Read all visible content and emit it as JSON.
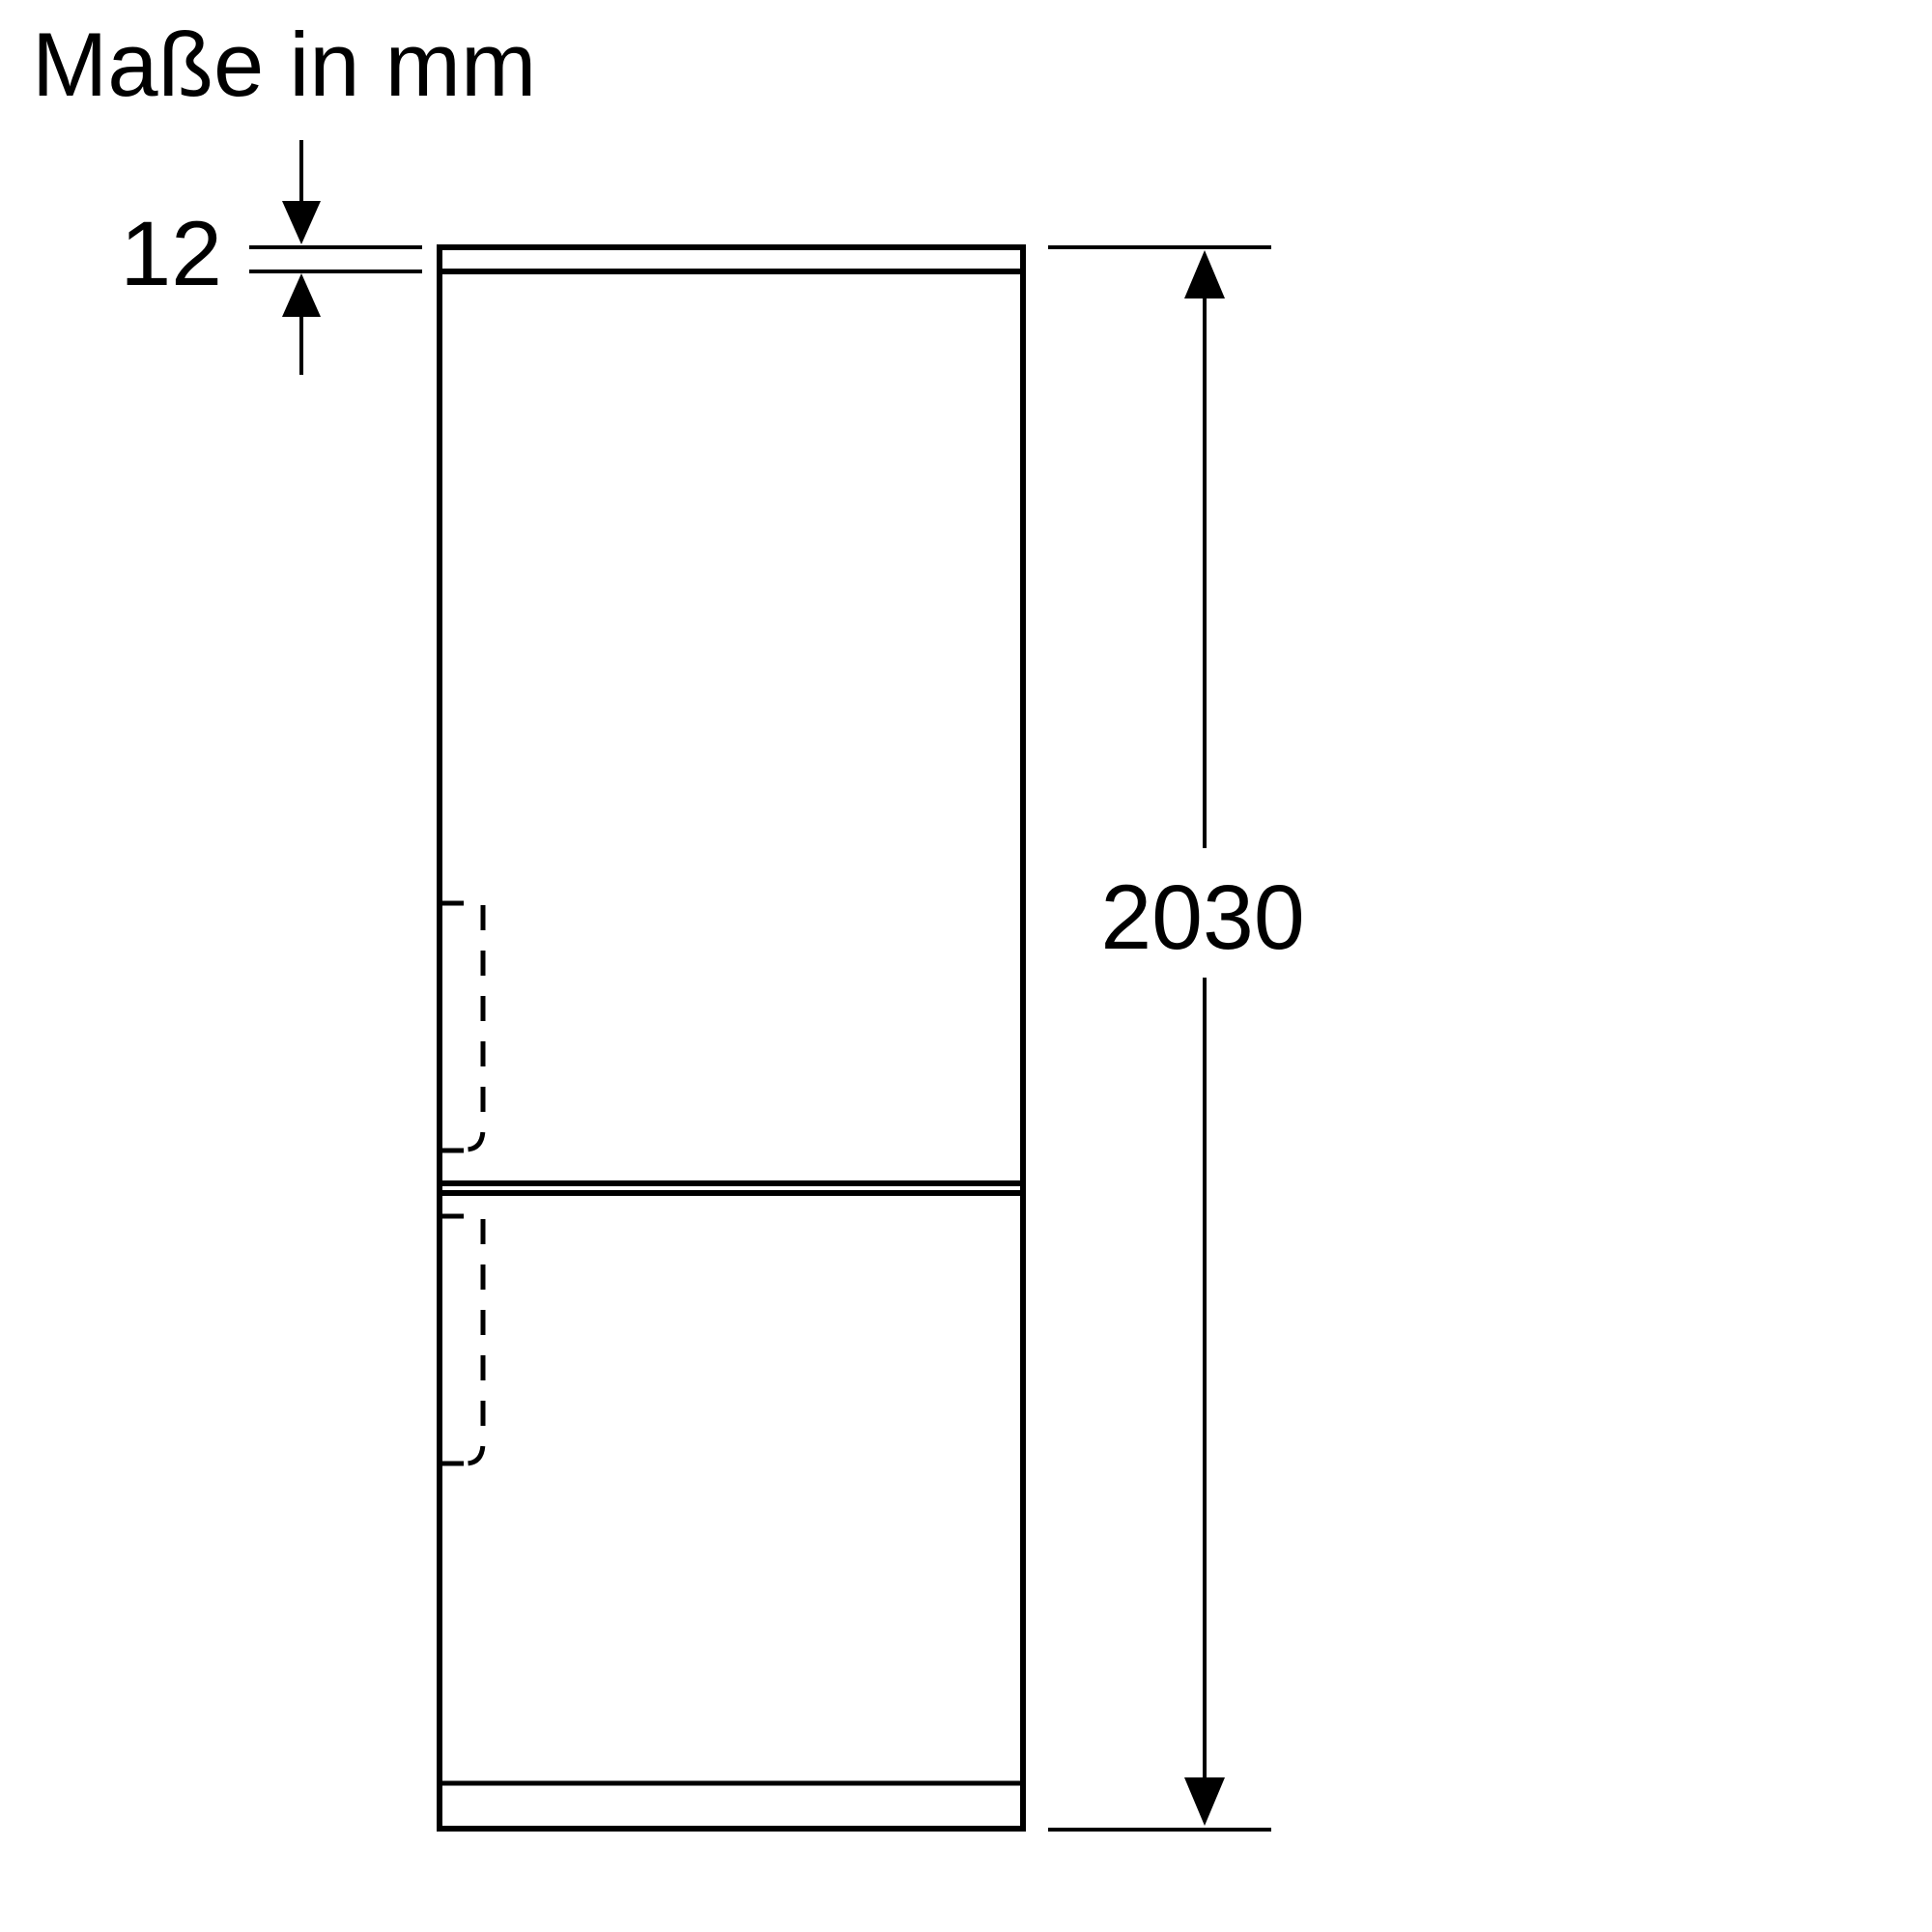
{
  "heading": "Maße in mm",
  "dimensions": {
    "top_panel_thickness": "12",
    "total_height": "2030"
  },
  "colors": {
    "background": "#ffffff",
    "line": "#000000"
  }
}
